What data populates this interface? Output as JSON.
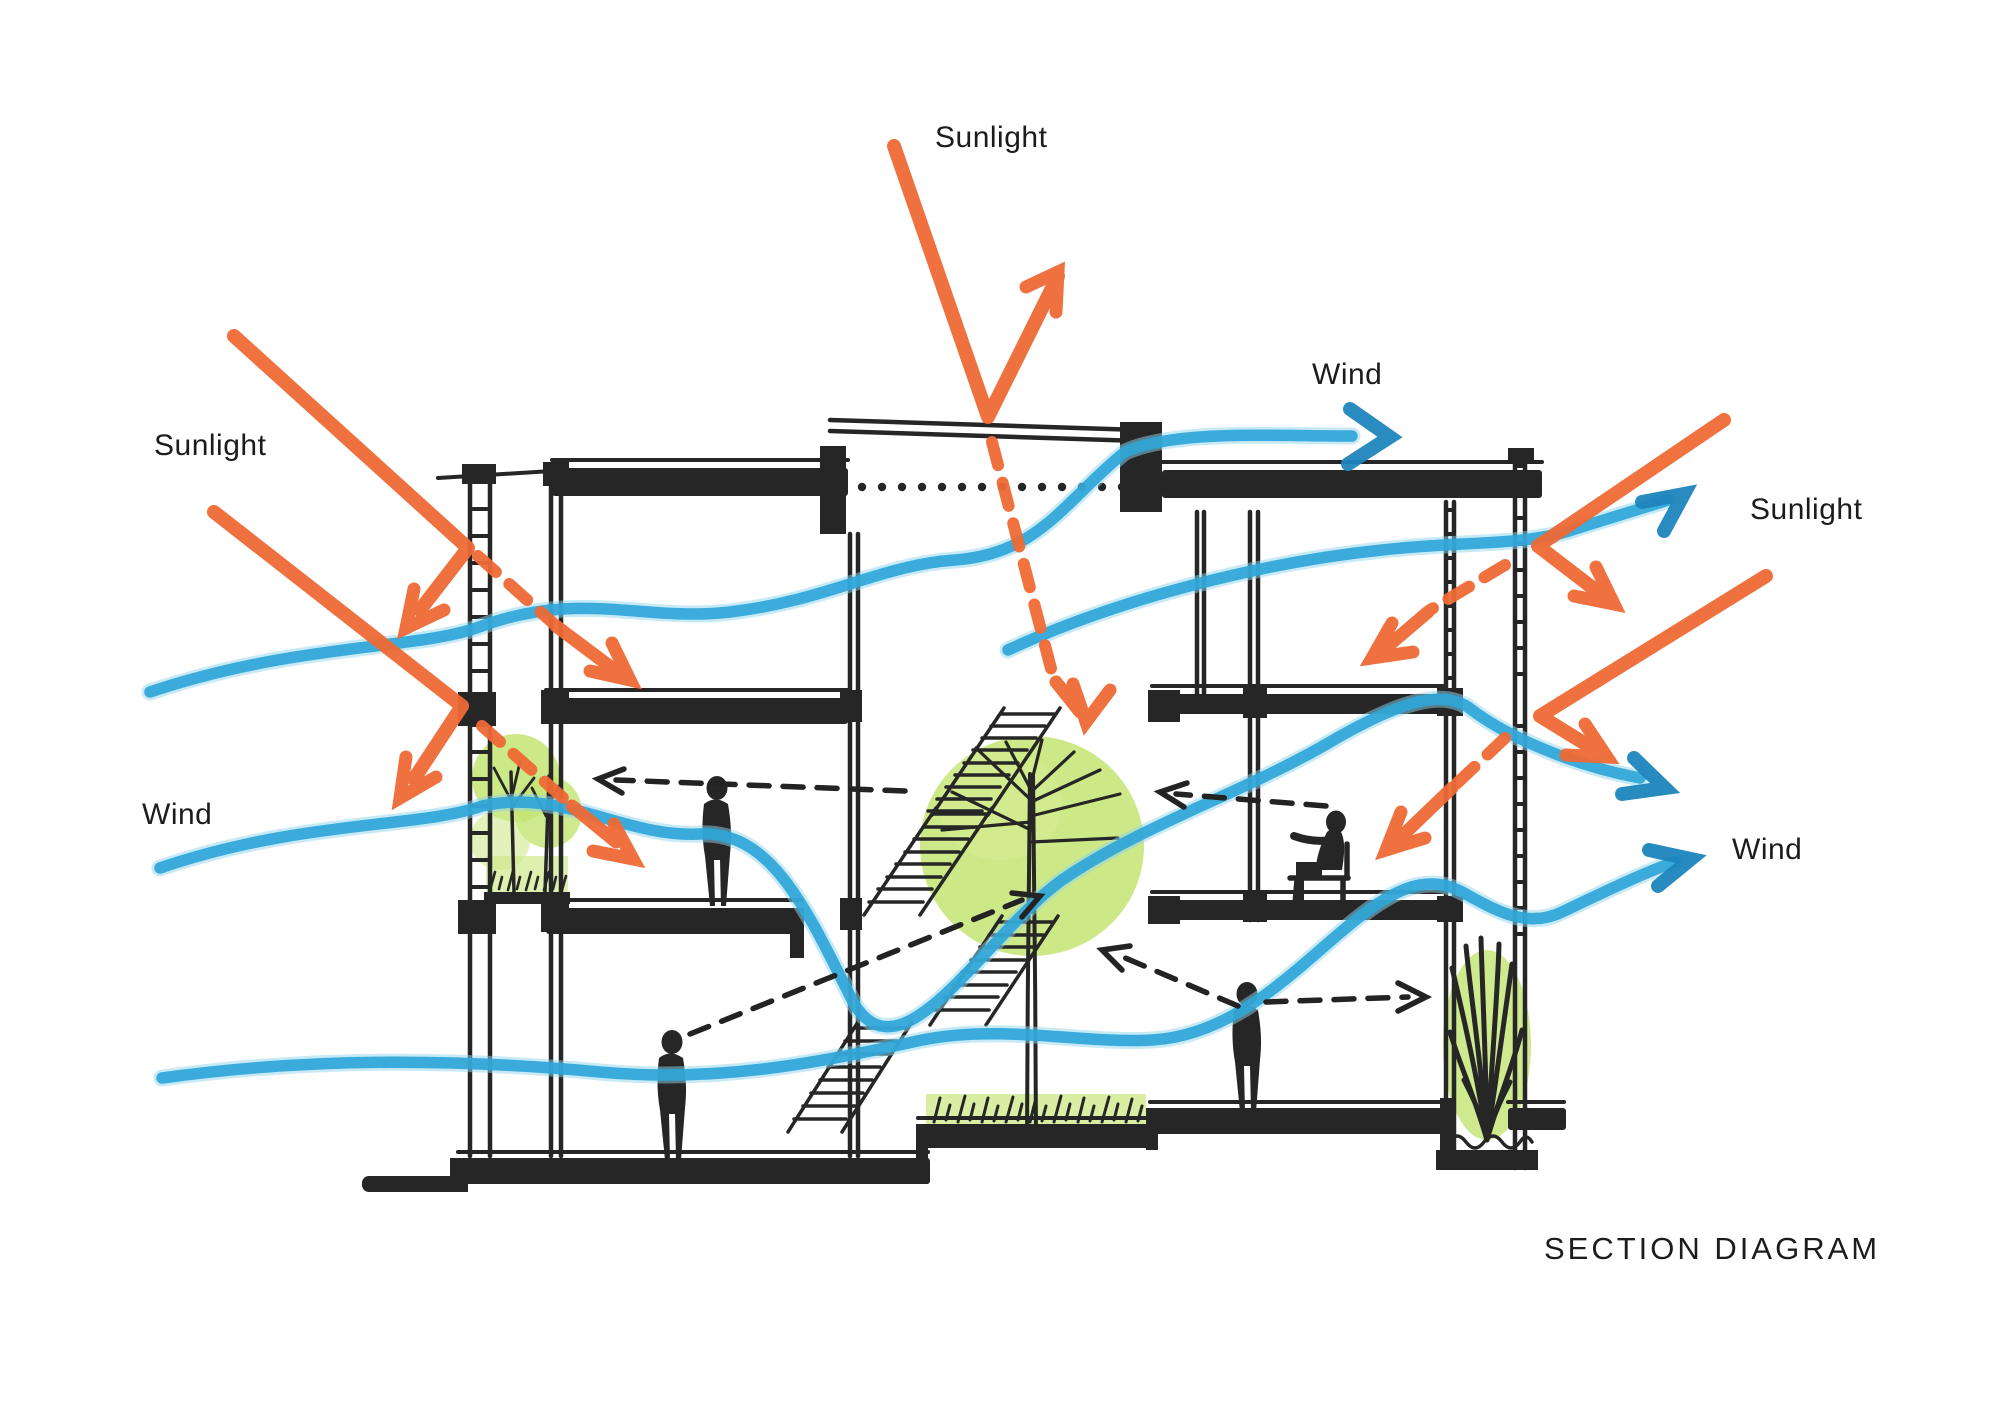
{
  "title": "SECTION DIAGRAM",
  "annotations": {
    "sunlight_top": {
      "text": "Sunlight"
    },
    "wind_top": {
      "text": "Wind"
    },
    "sunlight_left": {
      "text": "Sunlight"
    },
    "sunlight_right": {
      "text": "Sunlight"
    },
    "wind_left": {
      "text": "Wind"
    },
    "wind_right": {
      "text": "Wind"
    }
  },
  "legend": {
    "sunlight_arrows_color": "#ef6a35",
    "wind_flow_color": "#2fa6d8",
    "vegetation_color": "#c3e472",
    "ink_color": "#262626",
    "background_color": "#ffffff"
  },
  "scene": {
    "type": "hand-drawn architectural section",
    "storeys": 3,
    "elements": [
      "louvered-facades",
      "central-atrium-with-tree",
      "zigzag-stairs",
      "roof-canopy",
      "balcony-planting",
      "courtyard-grass",
      "agave-planter",
      "standing-people",
      "seated-person",
      "sun-rays",
      "wind-flow-lines",
      "interior-airflow-dashed-arrows"
    ]
  }
}
